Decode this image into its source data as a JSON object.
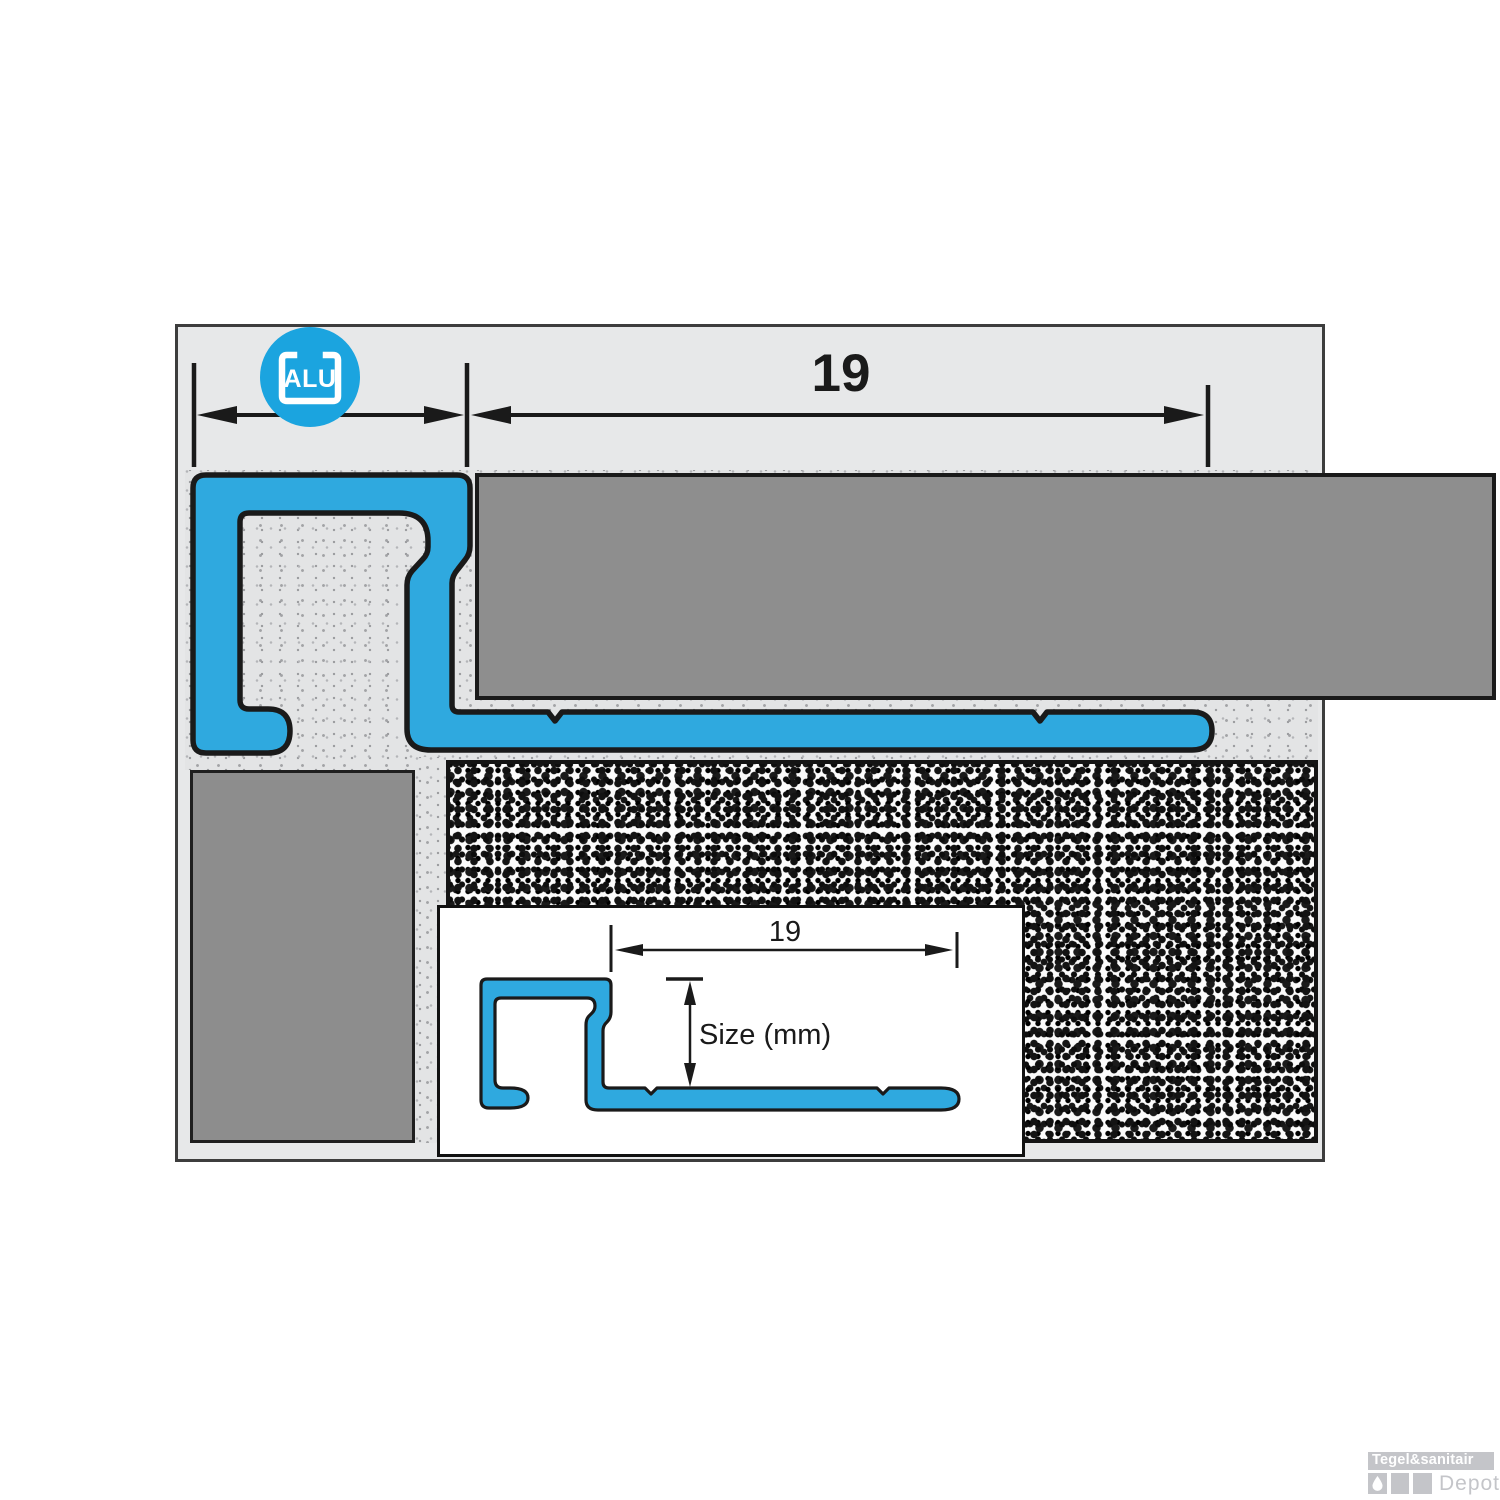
{
  "diagram": {
    "description": "cross-section of aluminium square-edge tile trim profile installed under a tile",
    "badge": {
      "label": "ALU"
    },
    "top_dimension": {
      "label": "19"
    },
    "inset": {
      "dimension_label": "19",
      "size_label": "Size (mm)"
    },
    "colors": {
      "profile_blue": "#2FA9DF",
      "badge_blue": "#1BA4DF",
      "tile_gray": "#8E8E8E",
      "diagram_background": "#E7E8E9",
      "outline_black": "#1A1A1A"
    }
  },
  "watermark": {
    "brand": "Tegel&sanitair",
    "sub_brand": "Depot",
    "icon": "water-drop-icon"
  }
}
